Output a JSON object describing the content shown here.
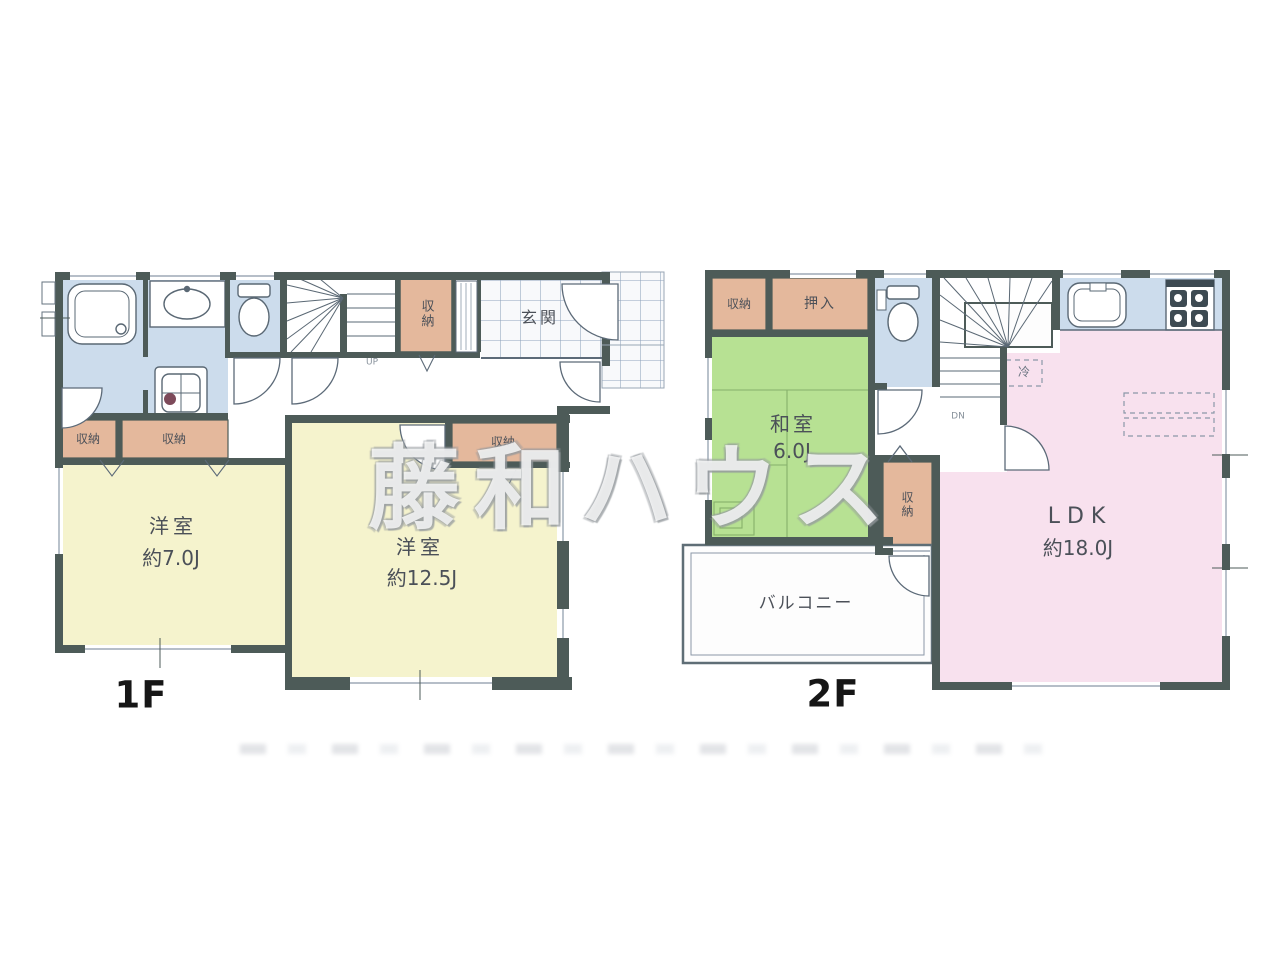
{
  "watermark": "藤和ハウス",
  "f1": {
    "label": "1F",
    "genkan": "玄関",
    "storage_stairs": "収納",
    "storage_a": "収納",
    "storage_b": "収納",
    "storage_room2": "収納",
    "room1_name": "洋室",
    "room1_size": "約7.0J",
    "room2_name": "洋室",
    "room2_size": "約12.5J",
    "up_mark": "UP"
  },
  "f2": {
    "label": "2F",
    "storage_top": "収納",
    "oshiire": "押入",
    "washitsu_name": "和室",
    "washitsu_size": "6.0J",
    "storage_side": "収納",
    "ldk_name": "LDK",
    "ldk_size": "約18.0J",
    "balcony": "バルコニー",
    "fridge": "冷",
    "dn_mark": "DN"
  },
  "colors": {
    "wall": "#4d5b58",
    "room_yellow": "#f5f3cd",
    "room_green": "#b7e193",
    "room_pink": "#f8e1ee",
    "storage_tan": "#e4b89c",
    "wet_blue": "#ccdcec",
    "tile_line": "#8fa3bc",
    "watermark_gray": "#c6c9cb"
  }
}
